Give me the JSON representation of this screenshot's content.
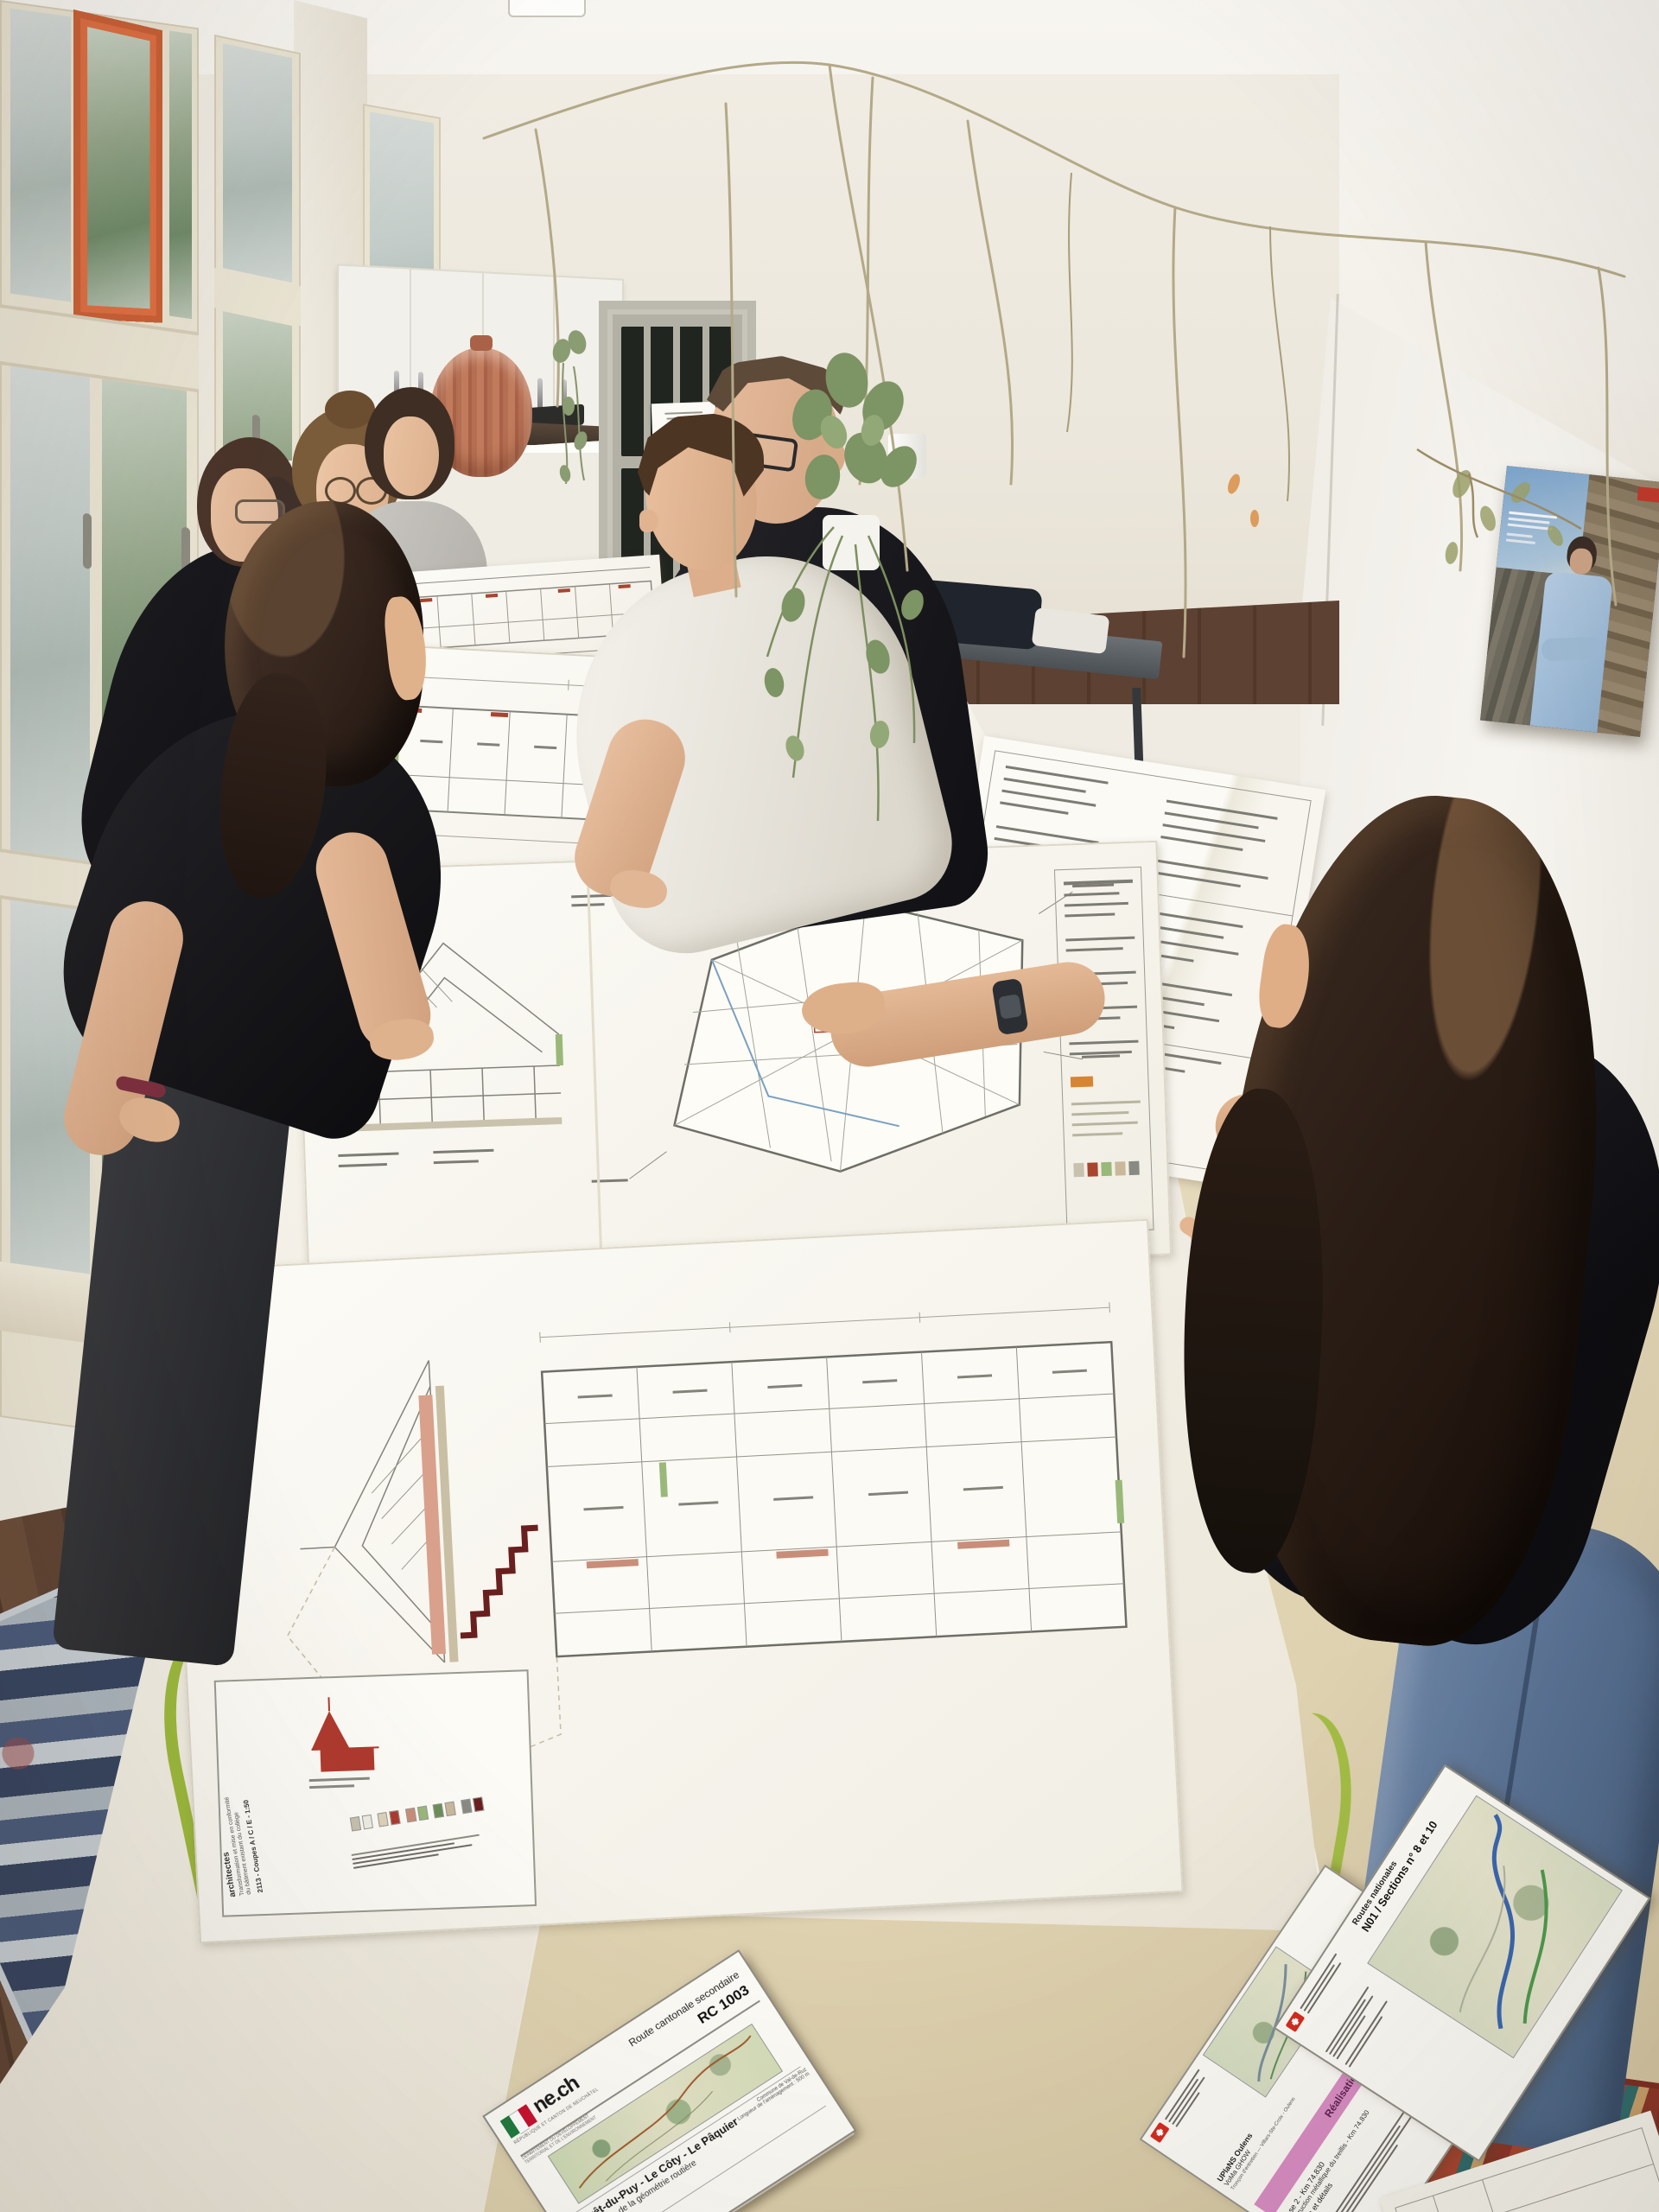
{
  "palette": {
    "wall": "#efeae0",
    "window_accent_orange": "#de6e42",
    "table_white": "#f4f1e8",
    "floor_beige": "#e0d4b4",
    "wood_floor": "#5f4333",
    "plan_line": "#8b8a82",
    "plan_red": "#b03a2e",
    "ne_green": "#1f7a3d",
    "ne_red": "#c8102e",
    "swiss_red": "#d52b1e",
    "pink_band": "#d98cc4",
    "bg_logo_green": "#1d6e4e",
    "poster_sky": "#7ba3cb"
  },
  "plan_titleblock": {
    "firm": "architectes",
    "project_line1": "Transformation et mise en conformité",
    "project_line2": "du bâtiment existant du collège",
    "sheet_ref": "2113 - Coupes A / C / E - 1:50"
  },
  "documents": {
    "rc1003": {
      "logo_text": "ne.ch",
      "canton_line": "RÉPUBLIQUE ET CANTON DE NEUCHÂTEL",
      "dept_line1": "DÉPARTEMENT DU DÉVELOPPEMENT",
      "dept_line2": "TERRITORIAL ET DE L'ENVIRONNEMENT",
      "route_type": "Route cantonale secondaire",
      "route_number": "RC 1003",
      "title": "Le Crêt-du-Puy - Le Côty - Le Pâquier",
      "subtitle": "Amélioration de la géométrie routière",
      "commune": "Commune de Val-de-Ruz",
      "length": "Longueur de l'aménagement : 500 m",
      "project": "Projet d'exécution"
    },
    "n01": {
      "category": "Routes nationales",
      "section": "N01 / Sections n° 8 et 10",
      "line1": "UPlaNS Oulens",
      "line2": "VoMa GHOW",
      "troncon": "Tronçon d'entretien — Villars-Ste-Croix - Oulens",
      "band": "Réalisation (RE)",
      "phase": "Phase 2 - Km 74.830",
      "subject": "Construction métallique du treillis - Km 74.830",
      "sheet": "Coupes et détails",
      "side_label": "T/U",
      "logo_bg": "BG"
    }
  }
}
